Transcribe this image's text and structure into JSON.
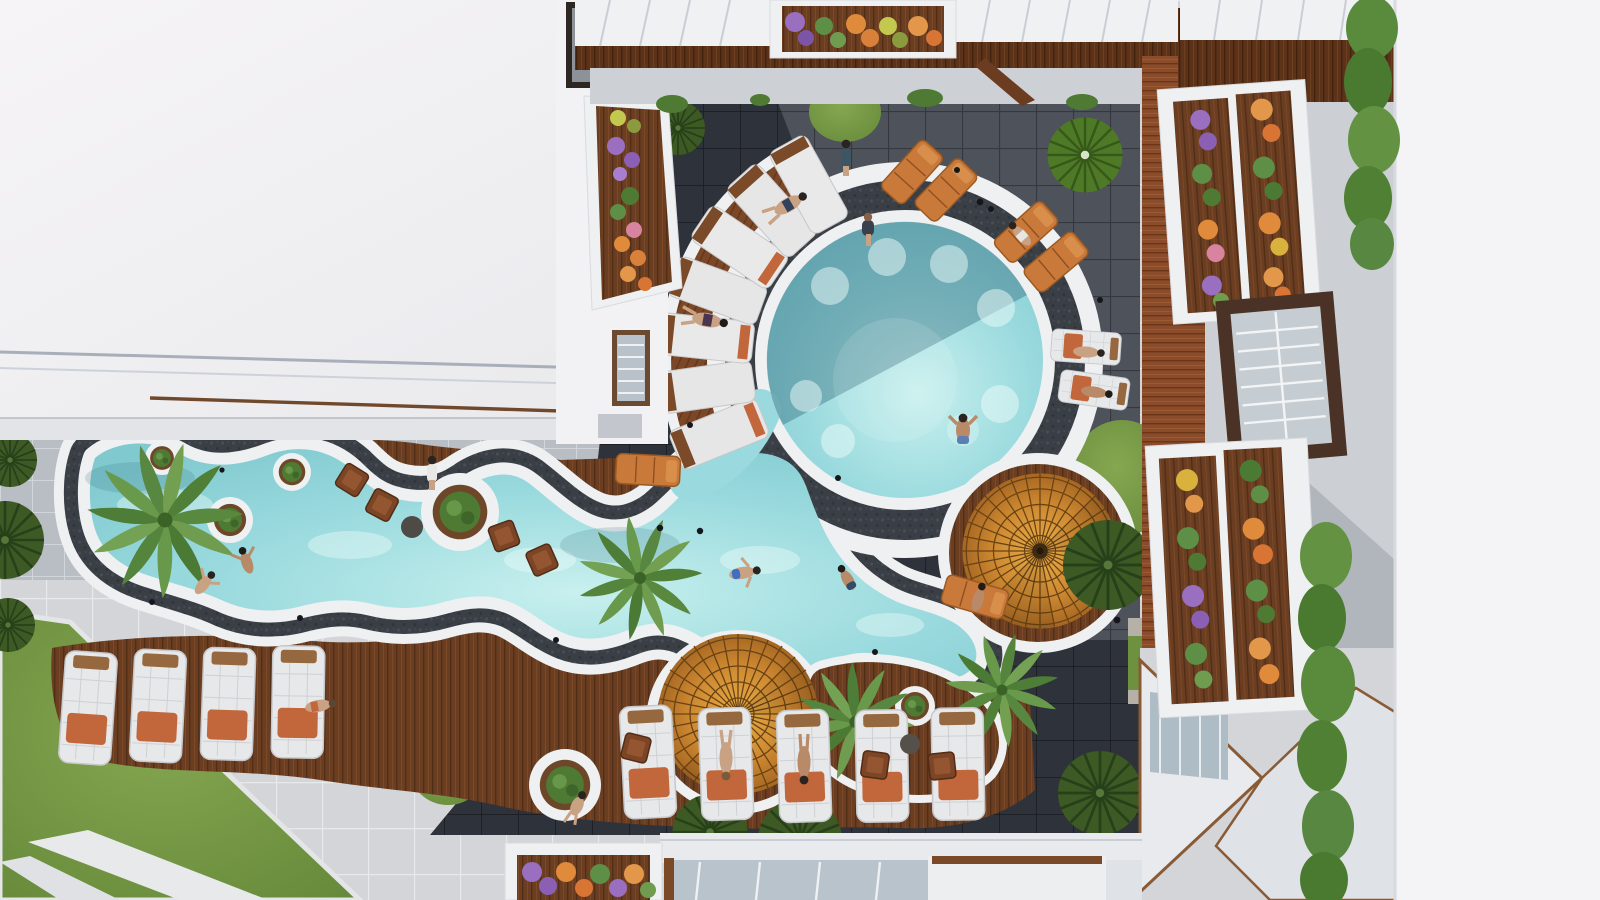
{
  "scene": {
    "label": "Aerial top-down view of a resort courtyard with a freeform swimming pool, sun decks, umbrellas and planted balconies",
    "type": "architectural-rendering-aerial",
    "time_of_day": "bright daylight with hard building shadows"
  },
  "palette": {
    "water_light": "#c8f0ee",
    "water_main": "#8fd4d8",
    "water_shadow_overlay": "rgba(25,80,100,0.35)",
    "pool_ring_white": "#eef0f1",
    "mosaic_band_dark": "#3a3e45",
    "tile_dark": "#2e323a",
    "tile_lit": "#4f545d",
    "tile_light": "#d3d5d8",
    "pavement_medium": "#b9bdc4",
    "deck_wood": "#6b3e22",
    "deck_wood_red": "#8a4c2a",
    "umbrella_orange": "#c9822e",
    "lawn_green": "#7aa04a",
    "bush_dark_green": "#3d5a25",
    "bush_light_green": "#527f2b",
    "lounger_white": "#e7e8e9",
    "towel_orange": "#c2663c",
    "chair_brown": "#7b4526",
    "roof_white": "#f1f0f2",
    "wall_white": "#f4f3f5",
    "flower_purple": "#9a6fc0",
    "flower_orange": "#e08a3c",
    "flower_yellow": "#d9b23e",
    "flower_pink": "#d884a0",
    "glass_blue": "#aebcc6"
  },
  "inventory": {
    "pools": [
      "round-main-pool",
      "lazy-river-pool",
      "connecting-channel"
    ],
    "umbrella_count": 2,
    "palm_tree_count": 4,
    "white_lounger_count": 11,
    "crescent_pad_count": 7,
    "orange_lounger_count": 6,
    "wood_chair_count": 7,
    "people_count": 16,
    "flower_planter_count": 6,
    "hedge_column_count": 2,
    "radial_bush_count": 6,
    "grass_circle_count": 5,
    "ring_planter_count": 6
  }
}
